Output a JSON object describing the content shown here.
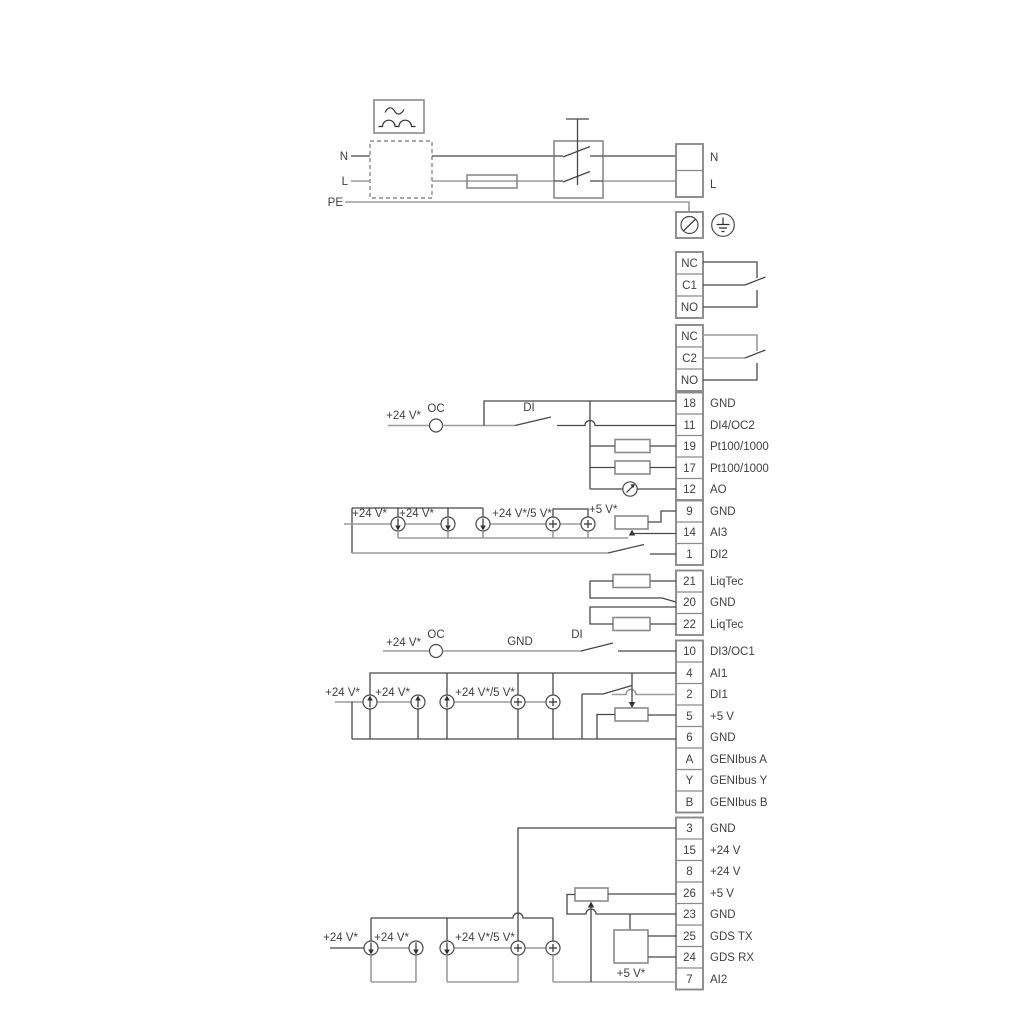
{
  "labels": {
    "v24": "+24 V*",
    "v24_5": "+24 V*/5 V*",
    "v5": "+5 V*",
    "oc": "OC",
    "di": "DI",
    "gnd": "GND"
  },
  "power": {
    "n": "N",
    "l": "L",
    "pe": "PE",
    "n_right": "N",
    "l_right": "L"
  },
  "relay1": {
    "nc": "NC",
    "c": "C1",
    "no": "NO"
  },
  "relay2": {
    "nc": "NC",
    "c": "C2",
    "no": "NO"
  },
  "t1": [
    {
      "num": "18",
      "label": "GND"
    },
    {
      "num": "11",
      "label": "DI4/OC2"
    },
    {
      "num": "19",
      "label": "Pt100/1000"
    },
    {
      "num": "17",
      "label": "Pt100/1000"
    },
    {
      "num": "12",
      "label": "AO"
    }
  ],
  "t2": [
    {
      "num": "9",
      "label": "GND"
    },
    {
      "num": "14",
      "label": "AI3"
    },
    {
      "num": "1",
      "label": "DI2"
    }
  ],
  "t3": [
    {
      "num": "21",
      "label": "LiqTec"
    },
    {
      "num": "20",
      "label": "GND"
    },
    {
      "num": "22",
      "label": "LiqTec"
    }
  ],
  "t4": [
    {
      "num": "10",
      "label": "DI3/OC1"
    },
    {
      "num": "4",
      "label": "AI1"
    },
    {
      "num": "2",
      "label": "DI1"
    },
    {
      "num": "5",
      "label": "+5 V"
    },
    {
      "num": "6",
      "label": "GND"
    },
    {
      "num": "A",
      "label": "GENIbus A"
    },
    {
      "num": "Y",
      "label": "GENIbus Y"
    },
    {
      "num": "B",
      "label": "GENIbus B"
    }
  ],
  "t5": [
    {
      "num": "3",
      "label": "GND"
    },
    {
      "num": "15",
      "label": "+24 V"
    },
    {
      "num": "8",
      "label": "+24 V"
    },
    {
      "num": "26",
      "label": "+5 V"
    },
    {
      "num": "23",
      "label": "GND"
    },
    {
      "num": "25",
      "label": "GDS TX"
    },
    {
      "num": "24",
      "label": "GDS RX"
    },
    {
      "num": "7",
      "label": "AI2"
    }
  ],
  "colors": {
    "wire_dark": "#474747",
    "wire_gray": "#9b9b9b",
    "box_border": "#8a8a8a"
  }
}
